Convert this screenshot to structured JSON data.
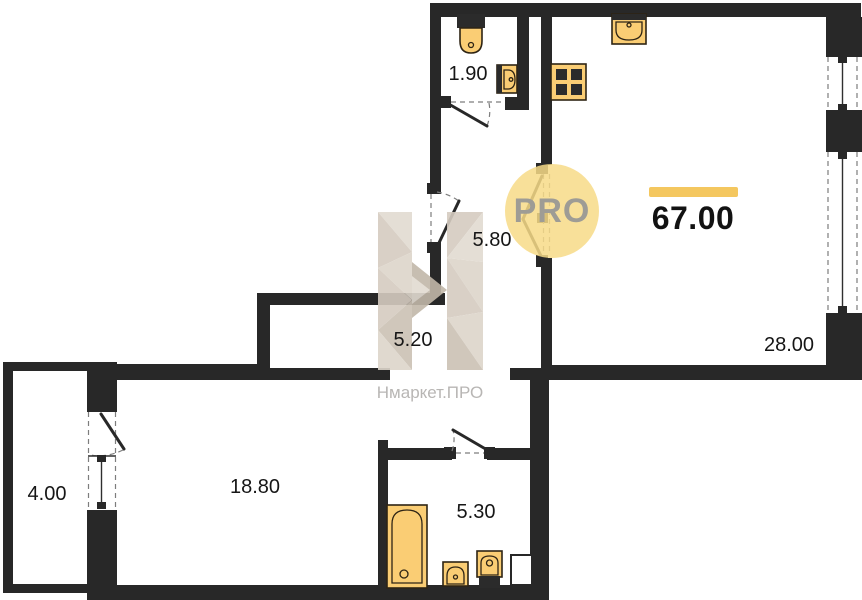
{
  "title": "Apartment floor plan",
  "watermark": {
    "pro_text": "PRO",
    "brand_text": "Нмаркет.ПРО"
  },
  "total_area_label": "67.00",
  "rooms": [
    {
      "name": "wc",
      "area": "1.90"
    },
    {
      "name": "hallway",
      "area": "5.80"
    },
    {
      "name": "corridor",
      "area": "5.20"
    },
    {
      "name": "kitchen-living-room",
      "area": "28.00"
    },
    {
      "name": "bedroom",
      "area": "18.80"
    },
    {
      "name": "balcony",
      "area": "4.00"
    },
    {
      "name": "bathroom",
      "area": "5.30"
    }
  ],
  "fixture_icons": [
    "toilet-icon",
    "wall-sink-icon",
    "stove-icon",
    "kitchen-sink-icon",
    "bathtub-icon",
    "bathroom-sink-icon",
    "bathroom-toilet-icon"
  ],
  "colors": {
    "wall": "#282828",
    "fixture_fill": "#FACD74",
    "fixture_stroke": "#2E2414",
    "fixture_dark": "#2B2B2B",
    "accent_bar": "#F4C75F",
    "pro_circle": "#F7DB87",
    "pro_text": "#9E9C95",
    "label_color": "#161616",
    "watermark_text": "#B8B6B4",
    "logo_beige_1": "#E2DBD1",
    "logo_beige_2": "#D5CCC0",
    "logo_beige_3": "#DDD5CA",
    "logo_beige_4": "#CBC1B4",
    "logo_beige_5": "#C2B7A9"
  }
}
